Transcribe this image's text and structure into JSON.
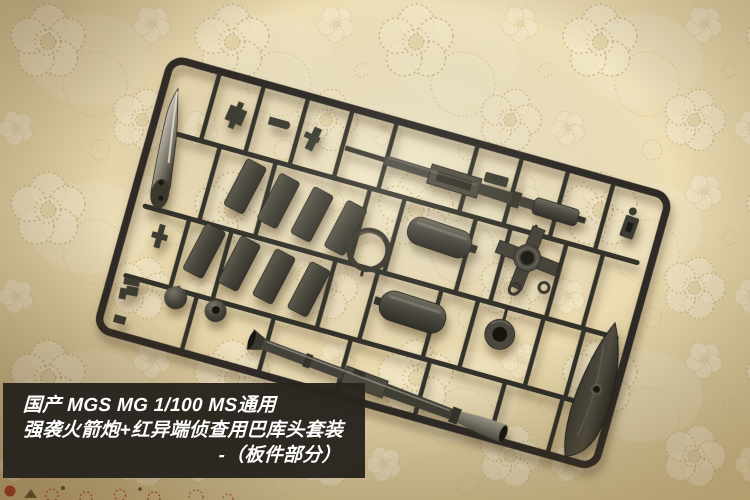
{
  "caption": {
    "line1": "国产 MGS MG 1/100 MS通用",
    "line2": "强袭火箭炮+红异端侦查用巴库头套装",
    "line3": "-（板件部分）"
  },
  "photo": {
    "subject": "plastic-model-kit-sprue-runner",
    "background": "cream-lace-fabric",
    "colors": {
      "fabric_base": "#e9dcb0",
      "fabric_highlight": "#f4ebce",
      "lace_outline": "#cbb685",
      "runner_plastic": "#32302a",
      "part_plastic": "#4a4840",
      "metal_highlight": "#c9c5b8",
      "caption_background": "#282420",
      "caption_text": "#ffffff",
      "accent_red": "#a82818"
    }
  }
}
